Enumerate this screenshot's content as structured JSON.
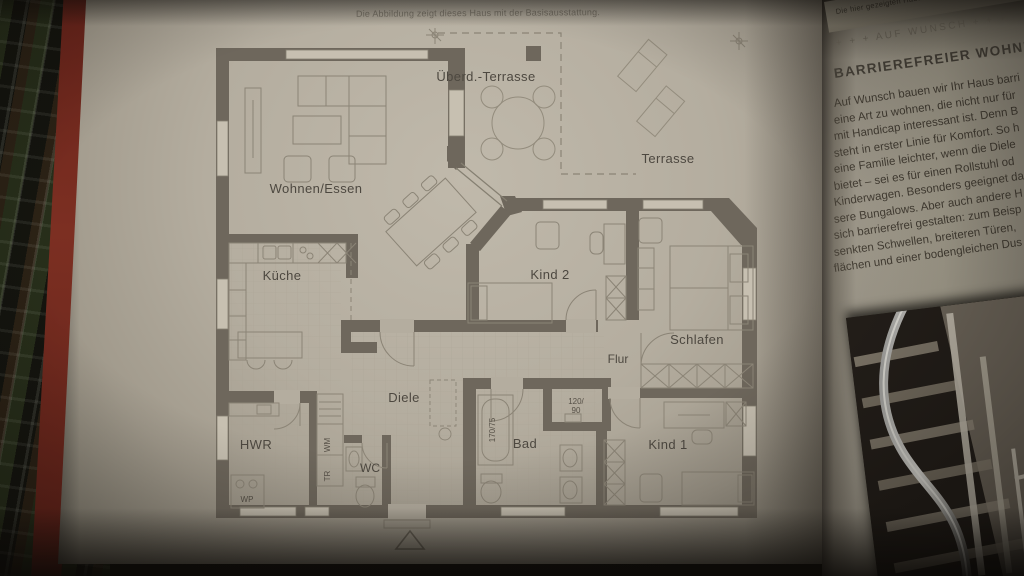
{
  "caption": "Die Abbildung zeigt dieses Haus mit der Basisausstattung.",
  "plan": {
    "room_labels": [
      {
        "id": "wohnen",
        "label": "Wohnen/Essen"
      },
      {
        "id": "kueche",
        "label": "Küche"
      },
      {
        "id": "ueberd",
        "label": "Überd.-Terrasse"
      },
      {
        "id": "terrasse",
        "label": "Terrasse"
      },
      {
        "id": "kind2",
        "label": "Kind 2"
      },
      {
        "id": "schlafen",
        "label": "Schlafen"
      },
      {
        "id": "flur",
        "label": "Flur"
      },
      {
        "id": "diele",
        "label": "Diele"
      },
      {
        "id": "hwr",
        "label": "HWR"
      },
      {
        "id": "wc",
        "label": "WC"
      },
      {
        "id": "bad",
        "label": "Bad"
      },
      {
        "id": "kind1",
        "label": "Kind 1"
      }
    ],
    "fixture_labels": {
      "bathtub_size": "170/75",
      "shower_width": "120/",
      "shower_depth": "90",
      "washing_machine": "WM",
      "dryer": "TR",
      "heat_pump": "WP"
    }
  },
  "right_page": {
    "top_note": "Die hier gezeigten Häuser verfügen",
    "kicker": "+ + + AUF WUNSCH + + +",
    "heading": "BARRIEREFREIER WOHNKOMFORT",
    "body_lines": [
      "Auf Wunsch bauen wir Ihr Haus barri",
      "eine Art zu wohnen, die nicht nur für",
      "mit Handicap interessant ist. Denn B",
      "steht in erster Linie für Komfort. So h",
      "eine Familie leichter, wenn die Diele",
      "bietet – sei es für einen Rollstuhl od",
      "Kinderwagen. Besonders geeignet da",
      "sere Bungalows. Aber auch andere H",
      "sich barrierefrei gestalten: zum Beisp",
      "senkten Schwellen, breiteren Türen,",
      "flächen und einer bodengleichen Dus"
    ]
  },
  "colors": {
    "wall": "#6e675c",
    "plan_line": "#8b8476",
    "window_fill": "#c7c0b1",
    "page": "#b4ad9f",
    "label_text": "#4d4840",
    "cover_red": "#7c2f22"
  }
}
